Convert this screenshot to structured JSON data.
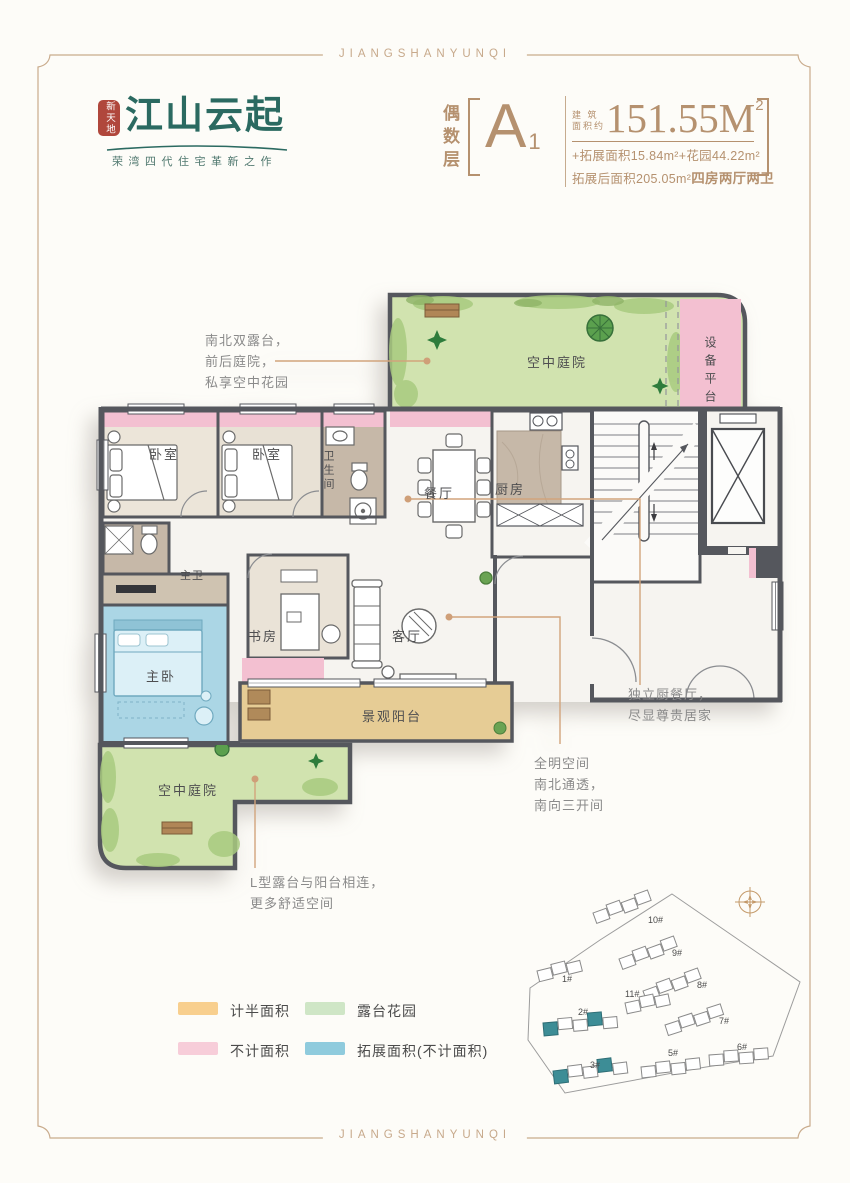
{
  "brand": {
    "header": "JIANGSHANYUNQI",
    "footer": "JIANGSHANYUNQI"
  },
  "logo": {
    "seal": "新天地",
    "name": "江山云起",
    "tagline": "荣湾四代住宅革新之作"
  },
  "title": {
    "floor": "偶数层",
    "unit": "A",
    "unit_sub": "1",
    "area_label_1": "建 筑",
    "area_label_2": "面积约",
    "area": "151.55M",
    "area_sup": "2",
    "line2": "+拓展面积15.84m²+花园44.22m²",
    "line3": "拓展后面积205.05m²",
    "line3_bold": "四房两厅两卫"
  },
  "rooms": {
    "courtyard_top": "空中庭院",
    "equipment": "设备平台",
    "bedroom1": "卧室",
    "bedroom2": "卧室",
    "bath": "卫生间",
    "dining": "餐厅",
    "kitchen": "厨房",
    "master_bath": "主卫",
    "master": "主卧",
    "study": "书房",
    "living": "客厅",
    "balcony": "景观阳台",
    "courtyard_bottom": "空中庭院"
  },
  "annotations": {
    "north": {
      "l1": "南北双露台，",
      "l2": "前后庭院，",
      "l3": "私享空中花园"
    },
    "kitchen": {
      "l1": "独立厨餐厅，",
      "l2": "尽显尊贵居家"
    },
    "living": {
      "l1": "全明空间",
      "l2": "南北通透，",
      "l3": "南向三开间"
    },
    "terrace": {
      "l1": "L型露台与阳台相连，",
      "l2": "更多舒适空间"
    }
  },
  "legend": {
    "items": [
      {
        "label": "计半面积",
        "color": "#f8cf8e"
      },
      {
        "label": "露台花园",
        "color": "#cfe6c6"
      },
      {
        "label": "不计面积",
        "color": "#f7cdd9"
      },
      {
        "label": "拓展面积(不计面积)",
        "color": "#8fcbdd"
      }
    ]
  },
  "sitemap": {
    "buildings": [
      {
        "label": "1#"
      },
      {
        "label": "2#"
      },
      {
        "label": "3#"
      },
      {
        "label": "5#"
      },
      {
        "label": "6#"
      },
      {
        "label": "7#"
      },
      {
        "label": "8#"
      },
      {
        "label": "9#"
      },
      {
        "label": "10#"
      },
      {
        "label": "11#"
      }
    ]
  },
  "colors": {
    "brand_teal": "#2b6a61",
    "seal_red": "#b0473c",
    "accent_tan": "#b5916f",
    "wall_gray": "#55575d",
    "garden_green": "#d1e3af",
    "pink_area": "#f3c0d1",
    "balcony_tan": "#e6cc95",
    "extension_blue": "#abd6e5"
  }
}
